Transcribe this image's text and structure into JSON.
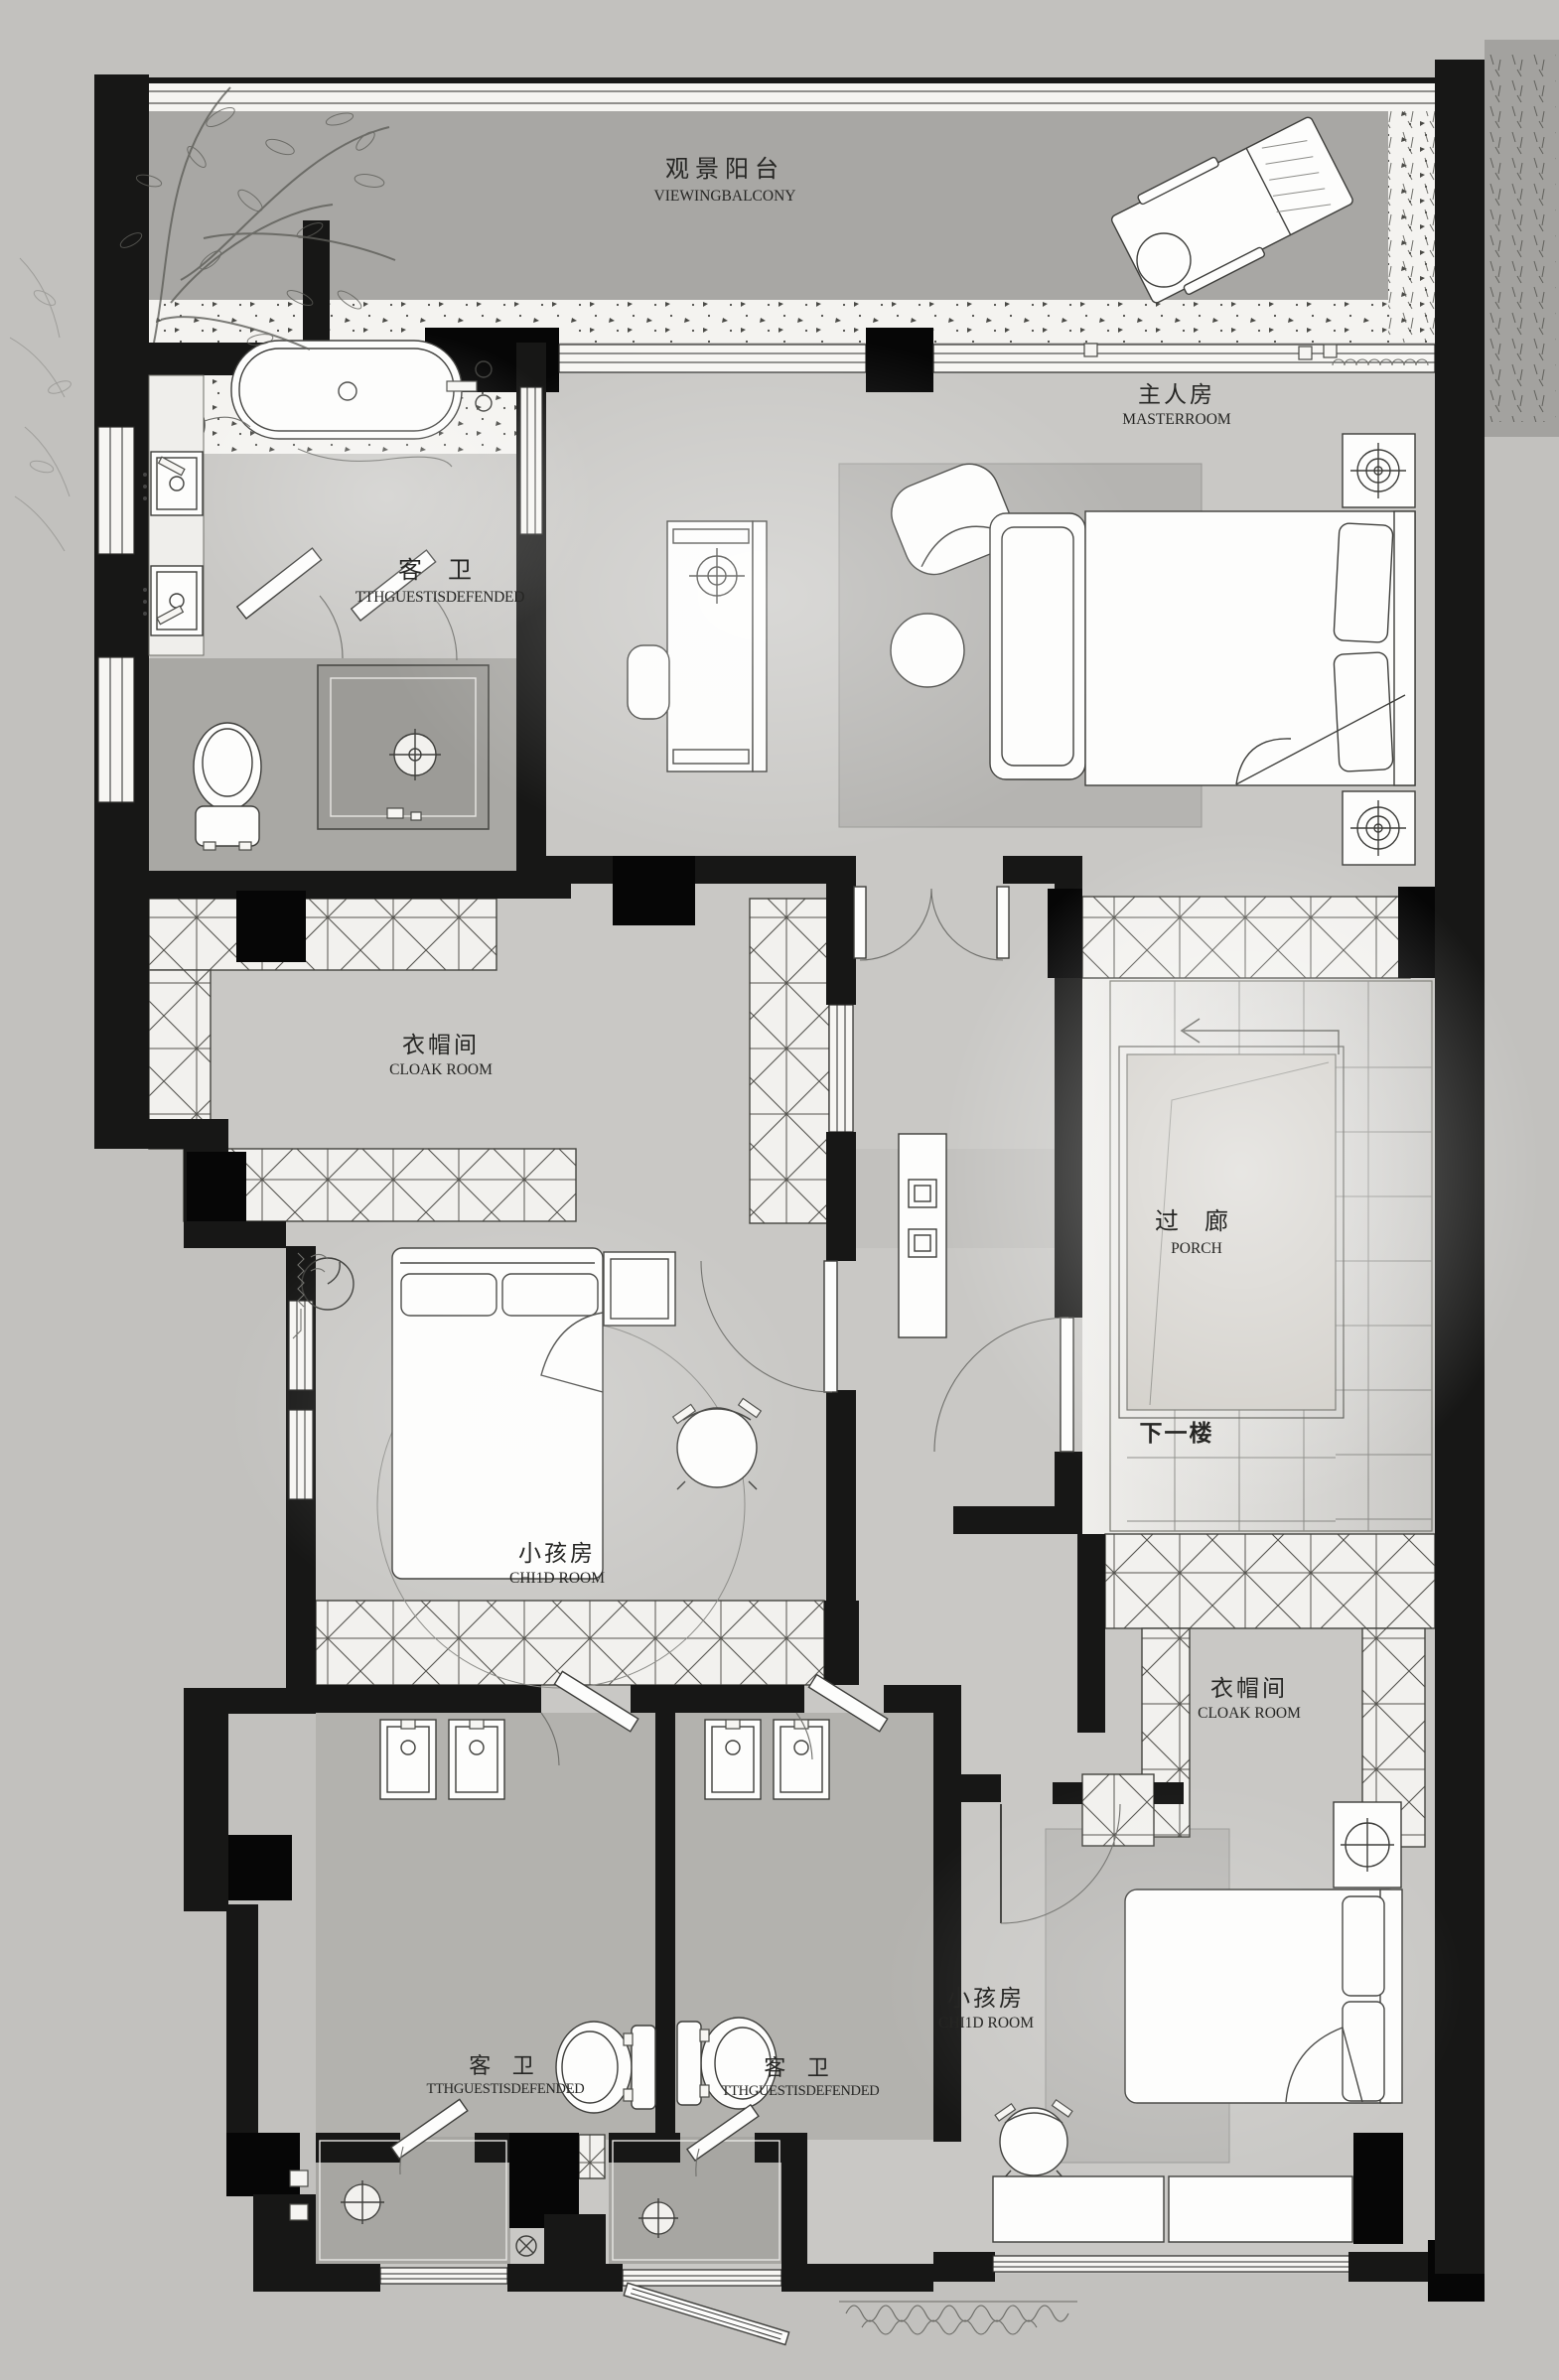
{
  "document": {
    "type": "residential floor plan (upper floor)"
  },
  "rooms": [
    {
      "id": "viewing-balcony",
      "label_zh": "观景阳台",
      "label_en": "VIEWINGBALCONY"
    },
    {
      "id": "master-room",
      "label_zh": "主人房",
      "label_en": "MASTERROOM"
    },
    {
      "id": "guest-bathroom-top",
      "label_zh": "客 卫",
      "label_en": "TTHGUESTISDEFENDED"
    },
    {
      "id": "cloak-room-left",
      "label_zh": "衣帽间",
      "label_en": "CLOAK ROOM"
    },
    {
      "id": "porch-stair-landing",
      "label_zh": "过 廊",
      "label_en": "PORCH"
    },
    {
      "id": "child-room-left",
      "label_zh": "小孩房",
      "label_en": "CHI1D ROOM"
    },
    {
      "id": "cloak-room-right",
      "label_zh": "衣帽间",
      "label_en": "CLOAK ROOM"
    },
    {
      "id": "guest-bathroom-bottom-left",
      "label_zh": "客 卫",
      "label_en": "TTHGUESTISDEFENDED"
    },
    {
      "id": "guest-bathroom-bottom-right",
      "label_zh": "客 卫",
      "label_en": "TTHGUESTISDEFENDED"
    },
    {
      "id": "child-room-bottom",
      "label_zh": "小孩房",
      "label_en": "CHI1D ROOM"
    }
  ],
  "annotations": {
    "stairs_down": "下一楼"
  },
  "colors": {
    "wall": "#171716",
    "outside": "#c2c1be",
    "floor": "#c9c8c5",
    "balcony_floor": "#a8a7a4",
    "wet_zone": "#a9a8a4",
    "shower": "#9c9b97",
    "rug": "#b5b4b1",
    "landing": "#d0cdc7",
    "hatch_bg": "#f2f1ee"
  }
}
